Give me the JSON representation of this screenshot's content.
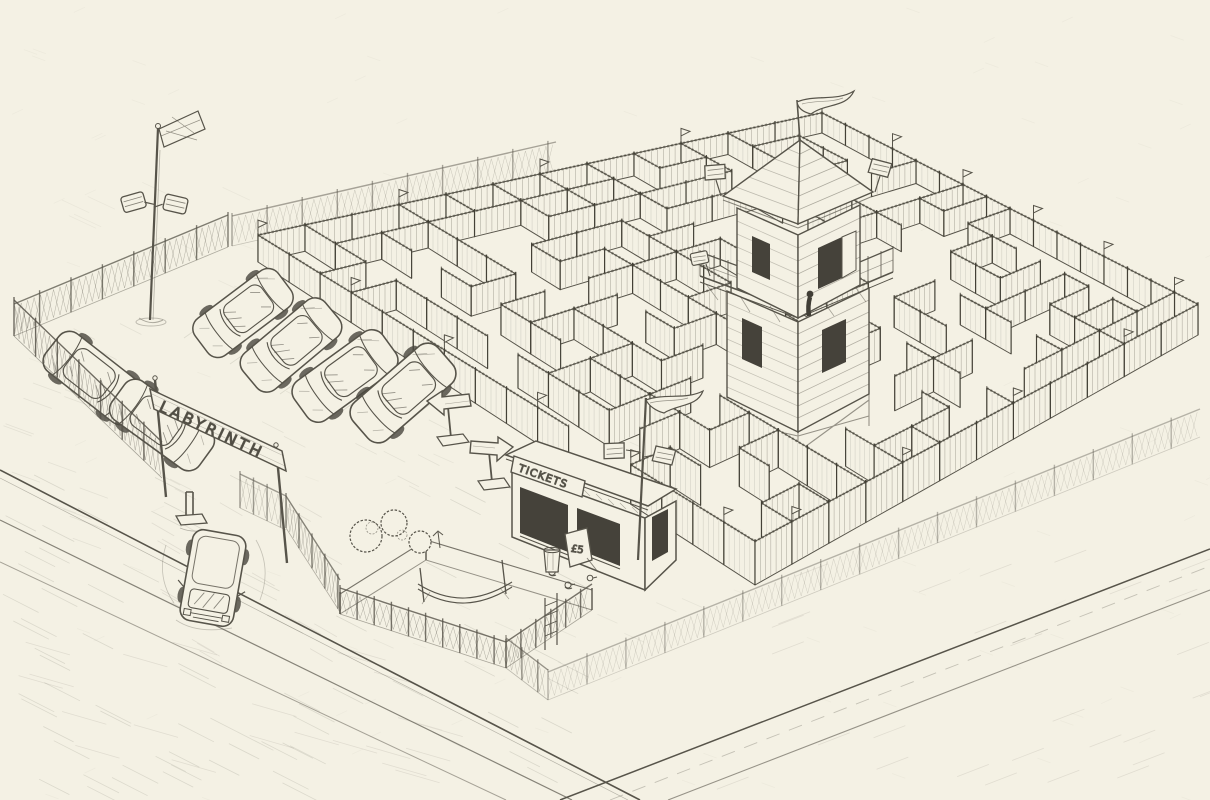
{
  "scene": {
    "type": "pencil-sketch-illustration",
    "subject": "Aerial perspective pencil sketch of an outdoor labyrinth maze attraction with parking lot, ticket booth, observation tower, flags and chain-link perimeter fence",
    "banner_text": "LABYRINTH",
    "ticket_sign_text": "TICKETS",
    "price_sign_text": "£5",
    "colors": {
      "paper": "#f4f1e4",
      "pencil": "#57544a",
      "pencil_dark": "#3c392f",
      "pencil_light": "#8b887b",
      "window_dark": "#45423a"
    },
    "elements": [
      "maze-walls",
      "observation-tower",
      "tower-flag",
      "roof-loudspeakers",
      "perimeter-chain-link-fence",
      "pennant-flags",
      "parking-lot",
      "parked-cars",
      "van",
      "entrance-banner",
      "entrance-gate",
      "bollard",
      "ticket-booth",
      "price-sign",
      "booth-flagpole",
      "loudspeakers",
      "direction-arrow-signs",
      "netted-enclosure",
      "bushes",
      "ducks",
      "roads",
      "floodlight-pole"
    ]
  }
}
